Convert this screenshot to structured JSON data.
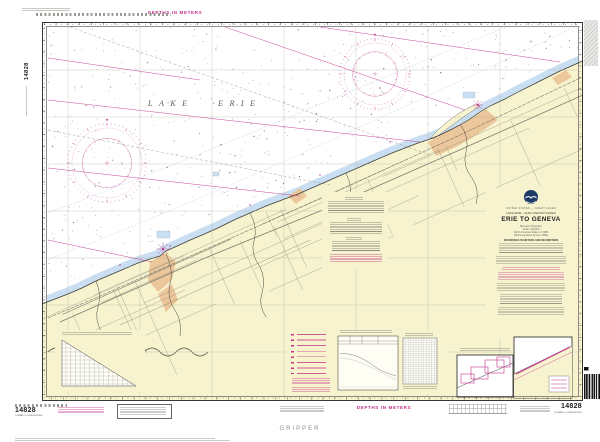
{
  "header": {
    "depths_top": "DEPTHS IN METERS",
    "depths_bottom": "DEPTHS IN METERS"
  },
  "map": {
    "lake_name": "LAKE ERIE"
  },
  "title_block": {
    "nation": "UNITED STATES — GREAT LAKES",
    "region": "LAKE ERIE · OHIO–PENNSYLVANIA",
    "title": "ERIE TO GENEVA",
    "lines": [
      "Mercator Projection",
      "Scale 1:80,000",
      "North American Datum of 1983",
      "(World Geodetic System 1984)"
    ],
    "soundings": "SOUNDINGS IN METERS AND DECIMETERS"
  },
  "ids": {
    "left_rotated": "14828",
    "bottom_left": "14828",
    "bottom_left_sub": "(LORAN-C OVERPRINTED)",
    "bottom_right": "14828",
    "bottom_right_sub": "(LORAN-C OVERPRINTED)"
  },
  "margin": {
    "gripper": "GRIPPER"
  },
  "palette": {
    "magenta": "#c2338c",
    "land": "#f7f3cf",
    "shallow_water": "#c9def0",
    "urban": "#ecc79b",
    "paper": "#ffffff"
  },
  "decor": {
    "seed": 11,
    "roads_parallel": 16,
    "roads_perp": 14,
    "soundings": 430,
    "roses": [
      {
        "cx": 107,
        "cy": 163,
        "r": 40
      },
      {
        "cx": 375,
        "cy": 74,
        "r": 36
      }
    ],
    "barcode": {
      "x": 584,
      "y": 374,
      "h": 25
    }
  }
}
